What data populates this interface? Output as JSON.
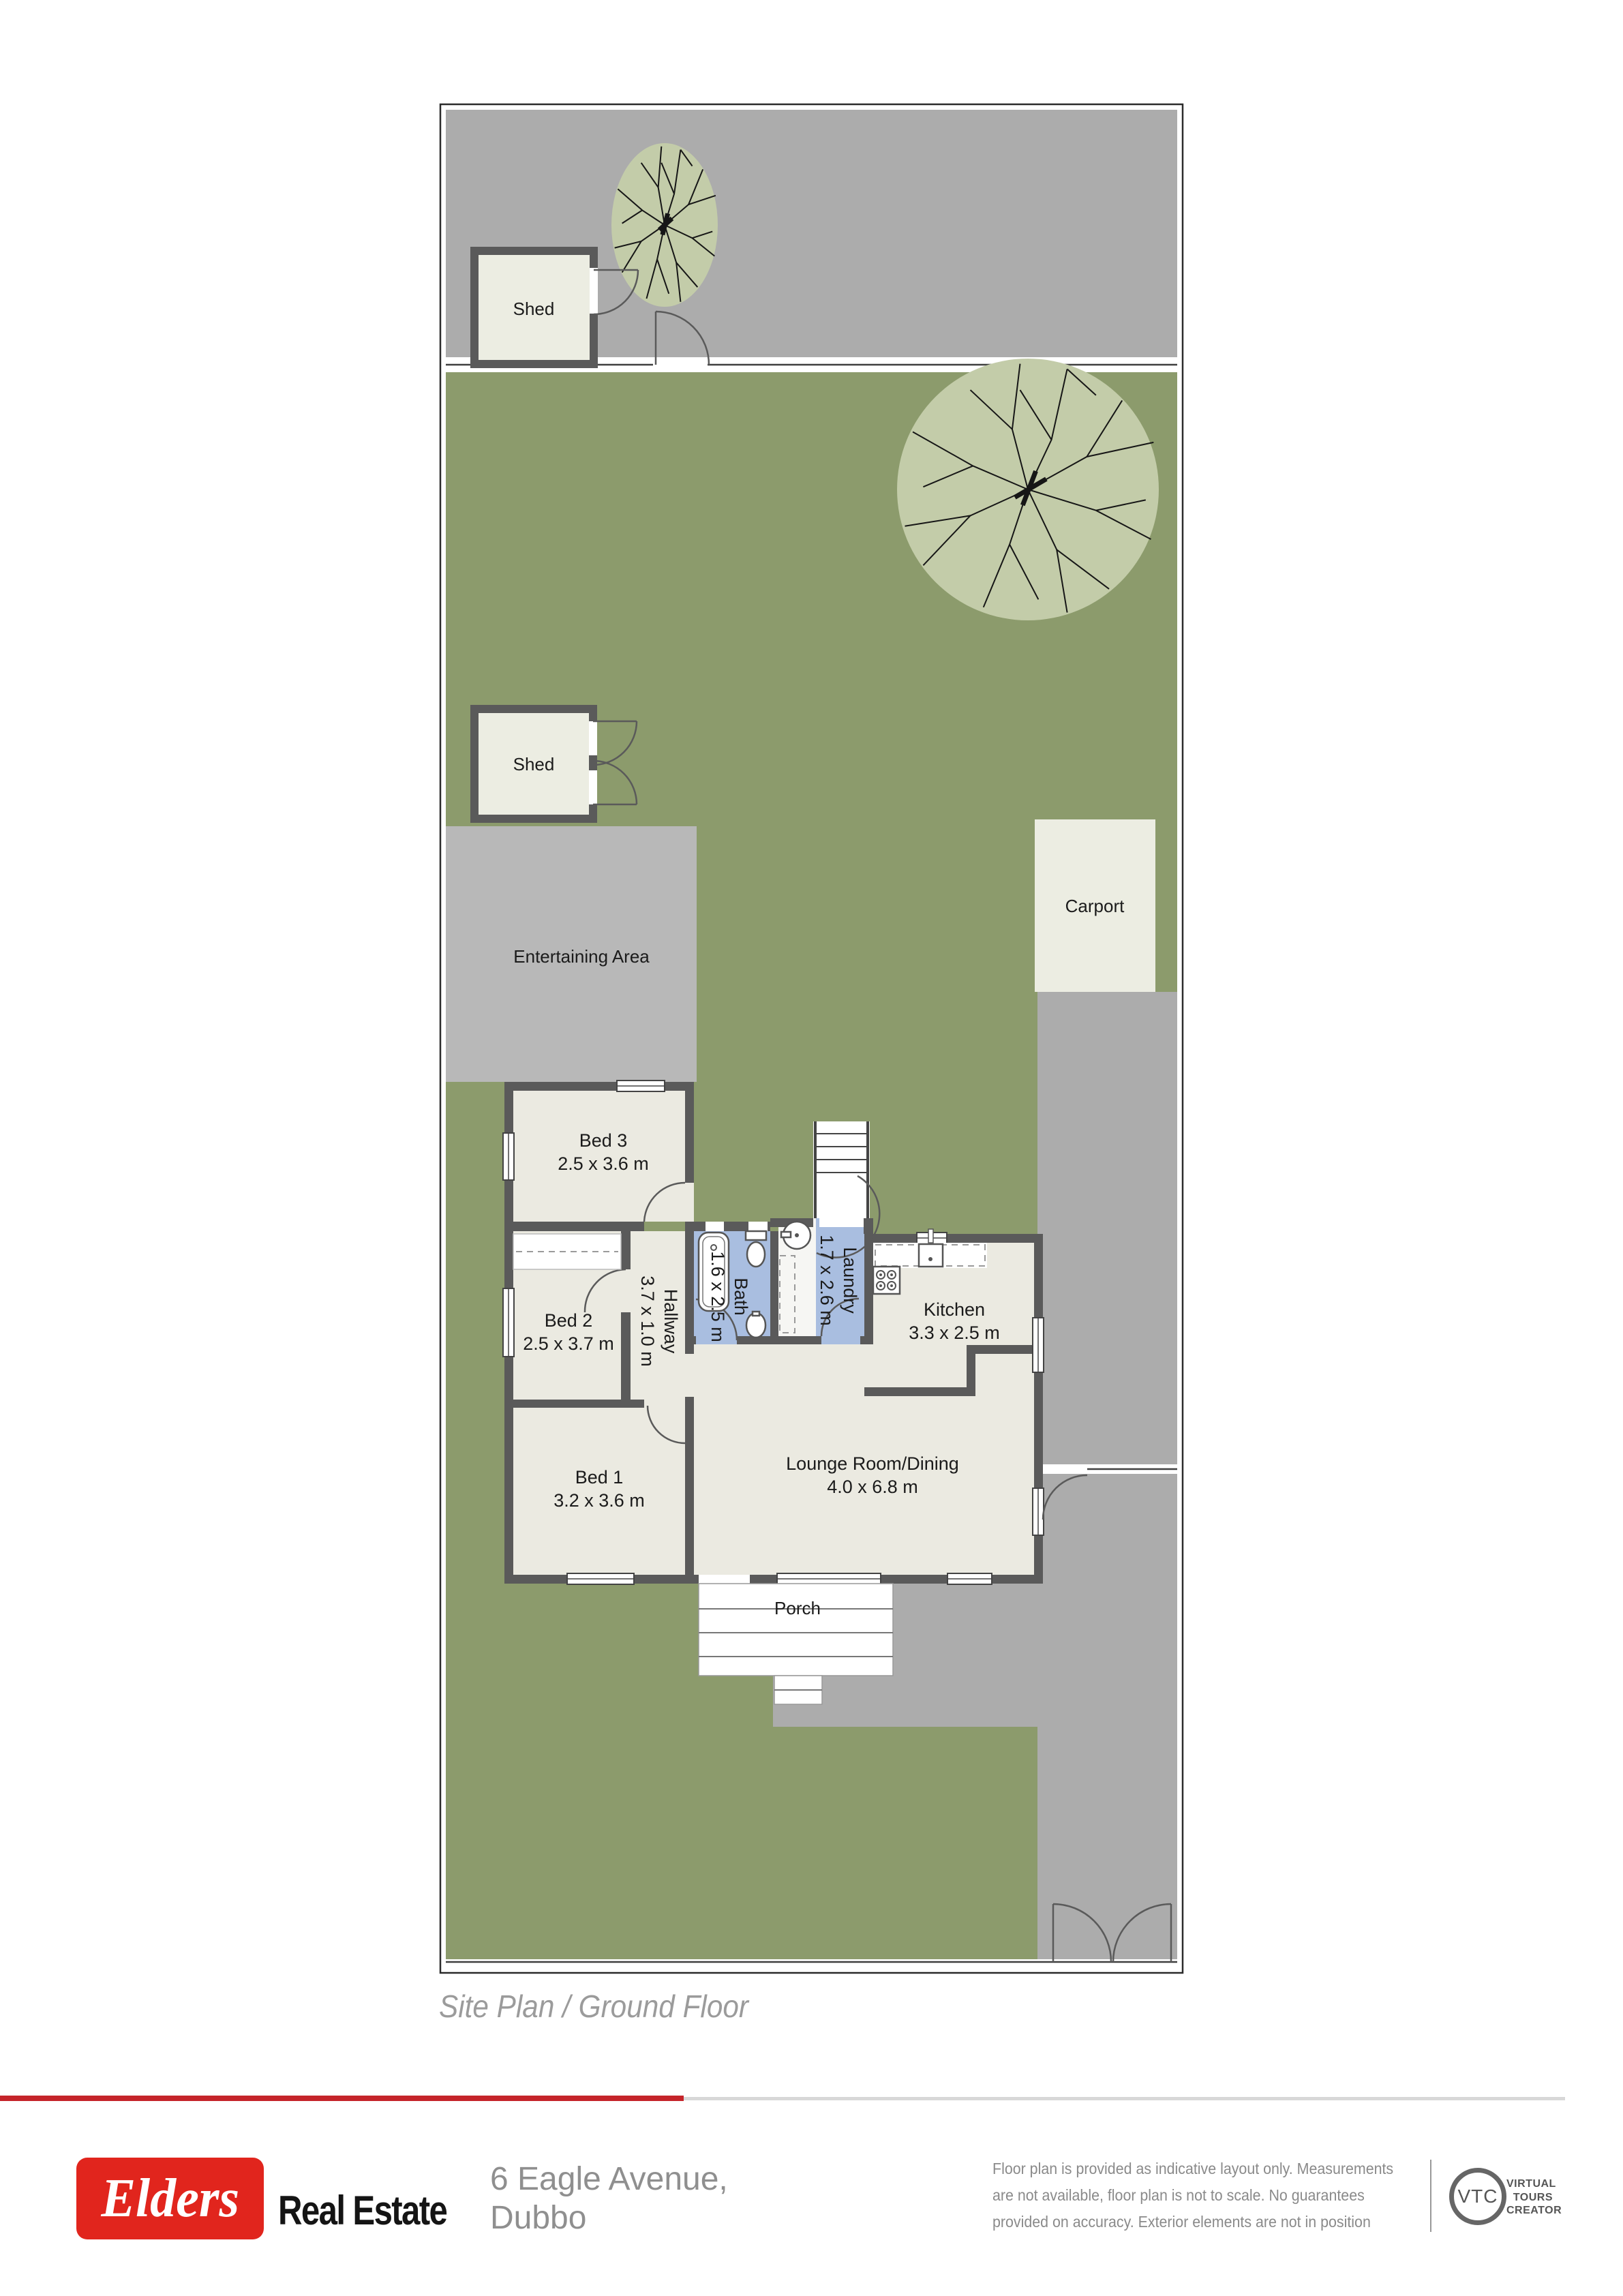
{
  "plan": {
    "caption": "Site Plan / Ground Floor",
    "areas": {
      "shed1": "Shed",
      "shed2": "Shed",
      "entertaining": "Entertaining Area",
      "carport": "Carport",
      "porch": "Porch"
    },
    "rooms": {
      "bed3": {
        "name": "Bed 3",
        "dims": "2.5 x 3.6 m"
      },
      "bed2": {
        "name": "Bed 2",
        "dims": "2.5 x 3.7 m"
      },
      "bed1": {
        "name": "Bed 1",
        "dims": "3.2 x 3.6 m"
      },
      "hallway": {
        "name": "Hallway",
        "dims": "3.7 x 1.0 m"
      },
      "bath": {
        "name": "Bath",
        "dims": "1.6 x 2.5 m"
      },
      "laundry": {
        "name": "Laundry",
        "dims": "1.7 x 2.6 m"
      },
      "kitchen": {
        "name": "Kitchen",
        "dims": "3.3 x 2.5 m"
      },
      "lounge": {
        "name": "Lounge Room/Dining",
        "dims": "4.0 x 6.8 m"
      }
    }
  },
  "footer": {
    "brand": "Elders",
    "brand_suffix": "Real Estate",
    "address_line1": "6 Eagle Avenue,",
    "address_line2": "Dubbo",
    "disclaimer": [
      "Floor plan is provided as indicative layout only. Measurements",
      "are not available, floor plan is not to scale. No guarantees",
      "provided on accuracy. Exterior elements are not in position"
    ],
    "vtc_abbr": "VTC",
    "vtc_words": [
      "VIRTUAL",
      "TOURS",
      "CREATOR"
    ]
  },
  "colors": {
    "brand_red": "#E1251D",
    "line_red": "#C5242A",
    "line_gray": "#D8D8D8",
    "grass": "#8C9B6C",
    "foliage": "#C3CCA9",
    "driveway": "#ACACAC",
    "entertaining": "#B8B8B8",
    "wall": "#5A5A5A",
    "room": "#EBEAE1",
    "wet_room": "#A9BEE0",
    "outbuilding": "#ECEDE2"
  }
}
